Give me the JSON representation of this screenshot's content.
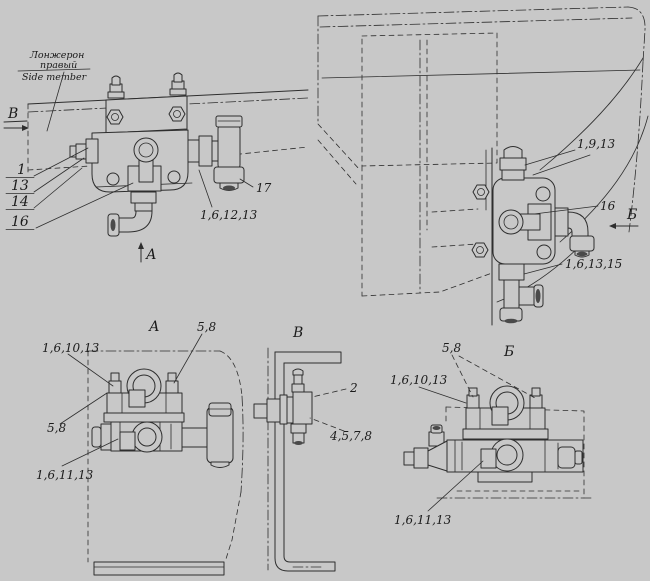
{
  "colors": {
    "background": "#c8c8c8",
    "line": "#2e2e2e",
    "text": "#1b1b1b"
  },
  "annotation": {
    "ru_line1": "Лонжерон",
    "ru_line2": "правый",
    "en": "Side member"
  },
  "main_view": {
    "arrow_v": "В",
    "arrow_a": "А",
    "stack": [
      "1",
      "13",
      "14",
      "16"
    ],
    "callout_17": "17",
    "callout_fitting": "1,6,12,13"
  },
  "cab_view": {
    "arrow_b": "Б",
    "callout_top": "1,9,13",
    "callout_valve": "16",
    "callout_bottom": "1,6,13,15"
  },
  "view_a": {
    "title": "А",
    "bolts_top": "5,8",
    "upper": "1,6,10,13",
    "bolts_left": "5,8",
    "lower": "1,6,11,13"
  },
  "view_v": {
    "title": "В",
    "bracket_valve": "2",
    "group": "4,5,7,8"
  },
  "view_b": {
    "title": "Б",
    "bolts": "5,8",
    "upper": "1,6,10,13",
    "lower": "1,6,11,13"
  }
}
